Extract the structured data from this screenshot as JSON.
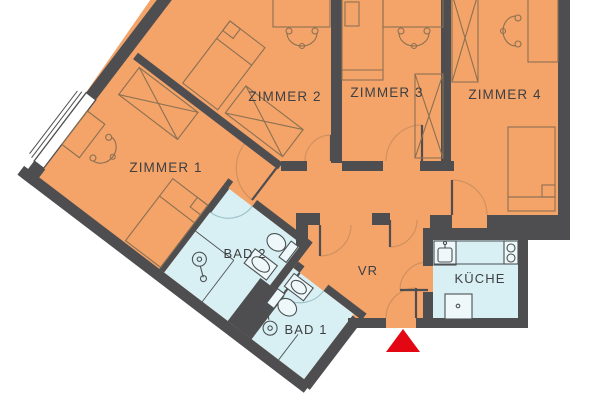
{
  "plan": {
    "title": "apartment-floor-plan",
    "rooms": {
      "zimmer1": {
        "label": "ZIMMER 1",
        "type": "bedroom"
      },
      "zimmer2": {
        "label": "ZIMMER 2",
        "type": "bedroom"
      },
      "zimmer3": {
        "label": "ZIMMER 3",
        "type": "bedroom"
      },
      "zimmer4": {
        "label": "ZIMMER 4",
        "type": "bedroom"
      },
      "bad2": {
        "label": "BAD 2",
        "type": "bathroom"
      },
      "bad1": {
        "label": "BAD 1",
        "type": "bathroom"
      },
      "vr": {
        "label": "VR",
        "type": "vestibule"
      },
      "kueche": {
        "label": "KÜCHE",
        "type": "kitchen"
      }
    },
    "colors": {
      "room_orange": "#f4a369",
      "wet_room_blue": "#d8f0f3",
      "wall_gray": "#4e4e50",
      "furniture_brown": "#8a7152",
      "fixture_gray": "#4c5154",
      "fixture_fill": "#eef8fa",
      "door_arc_tan": "#d0925e",
      "door_arc_blue": "#9fc3c9",
      "label_gray": "#3f4043",
      "entrance_red": "#e30613",
      "window_white": "#ffffff",
      "background": "#ffffff"
    },
    "entrance_marker": "red-triangle",
    "icons": [
      "bed-icon",
      "wardrobe-x-icon",
      "desk-icon",
      "chair-icon",
      "toilet-icon",
      "sink-icon",
      "shower-drain-icon",
      "kitchen-sink-icon",
      "stove-icon",
      "fridge-icon",
      "door-swing-icon",
      "window-icon"
    ]
  }
}
